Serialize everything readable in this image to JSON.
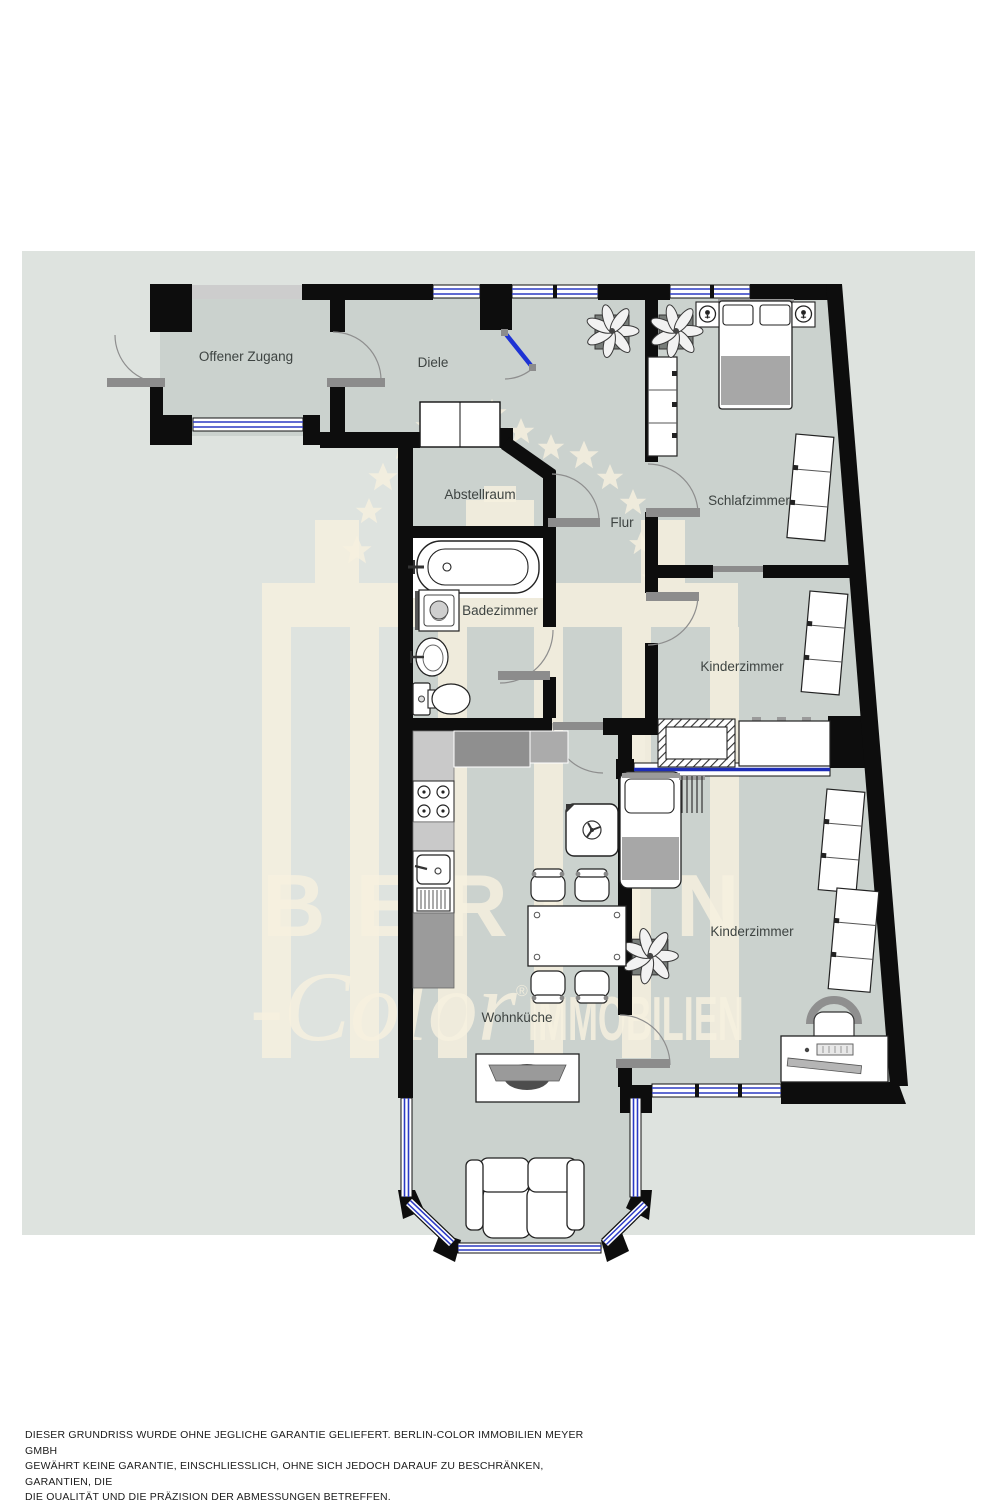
{
  "document": {
    "type": "apartment-floor-plan"
  },
  "plan": {
    "rooms": [
      {
        "label": "Offener Zugang"
      },
      {
        "label": "Diele"
      },
      {
        "label": "Abstellraum"
      },
      {
        "label": "Flur"
      },
      {
        "label": "Badezimmer"
      },
      {
        "label": "Schlafzimmer"
      },
      {
        "label": "Kinderzimmer"
      },
      {
        "label": "Kinderzimmer"
      },
      {
        "label": "Wohnküche"
      }
    ],
    "symbols": [
      "double-bed",
      "single-bed",
      "crib",
      "wardrobe",
      "nightstand-lamp",
      "plant",
      "bathtub",
      "washing-machine",
      "bathroom-sink",
      "toilet",
      "stove",
      "kitchen-sink",
      "boiler-fan",
      "dining-table",
      "chair",
      "desk",
      "desk-chair",
      "sofa",
      "tv-sideboard",
      "window",
      "door-swing"
    ]
  },
  "watermark": {
    "brand_top": "BERLIN",
    "brand_script": "-Color",
    "registered_mark": "®",
    "brand_bottom": "IMMOBILIEN"
  },
  "disclaimer": {
    "lines": [
      "DIESER GRUNDRISS WURDE OHNE JEGLICHE GARANTIE GELIEFERT. BERLIN-COLOR IMMOBILIEN MEYER GMBH",
      "GEWÄHRT KEINE GARANTIE, EINSCHLIESSLICH, OHNE SICH JEDOCH DARAUF ZU BESCHRÄNKEN, GARANTIEN, DIE",
      "DIE QUALITÄT UND DIE PRÄZISION DER ABMESSUNGEN BETREFFEN."
    ]
  },
  "colors": {
    "page_background": "#ffffff",
    "plan_background": "#dee3df",
    "floor": "#cbd2ce",
    "wall": "#0d0d0d",
    "window_glass": "#2b3ac4",
    "glass_door_leaf": "#1e33d4",
    "door_swing": "#8e8e8e",
    "threshold": "#8c8c8c",
    "watermark_cream": "#f6f0df",
    "label_text": "#3e4442",
    "disclaimer_text": "#1b1b1b"
  }
}
